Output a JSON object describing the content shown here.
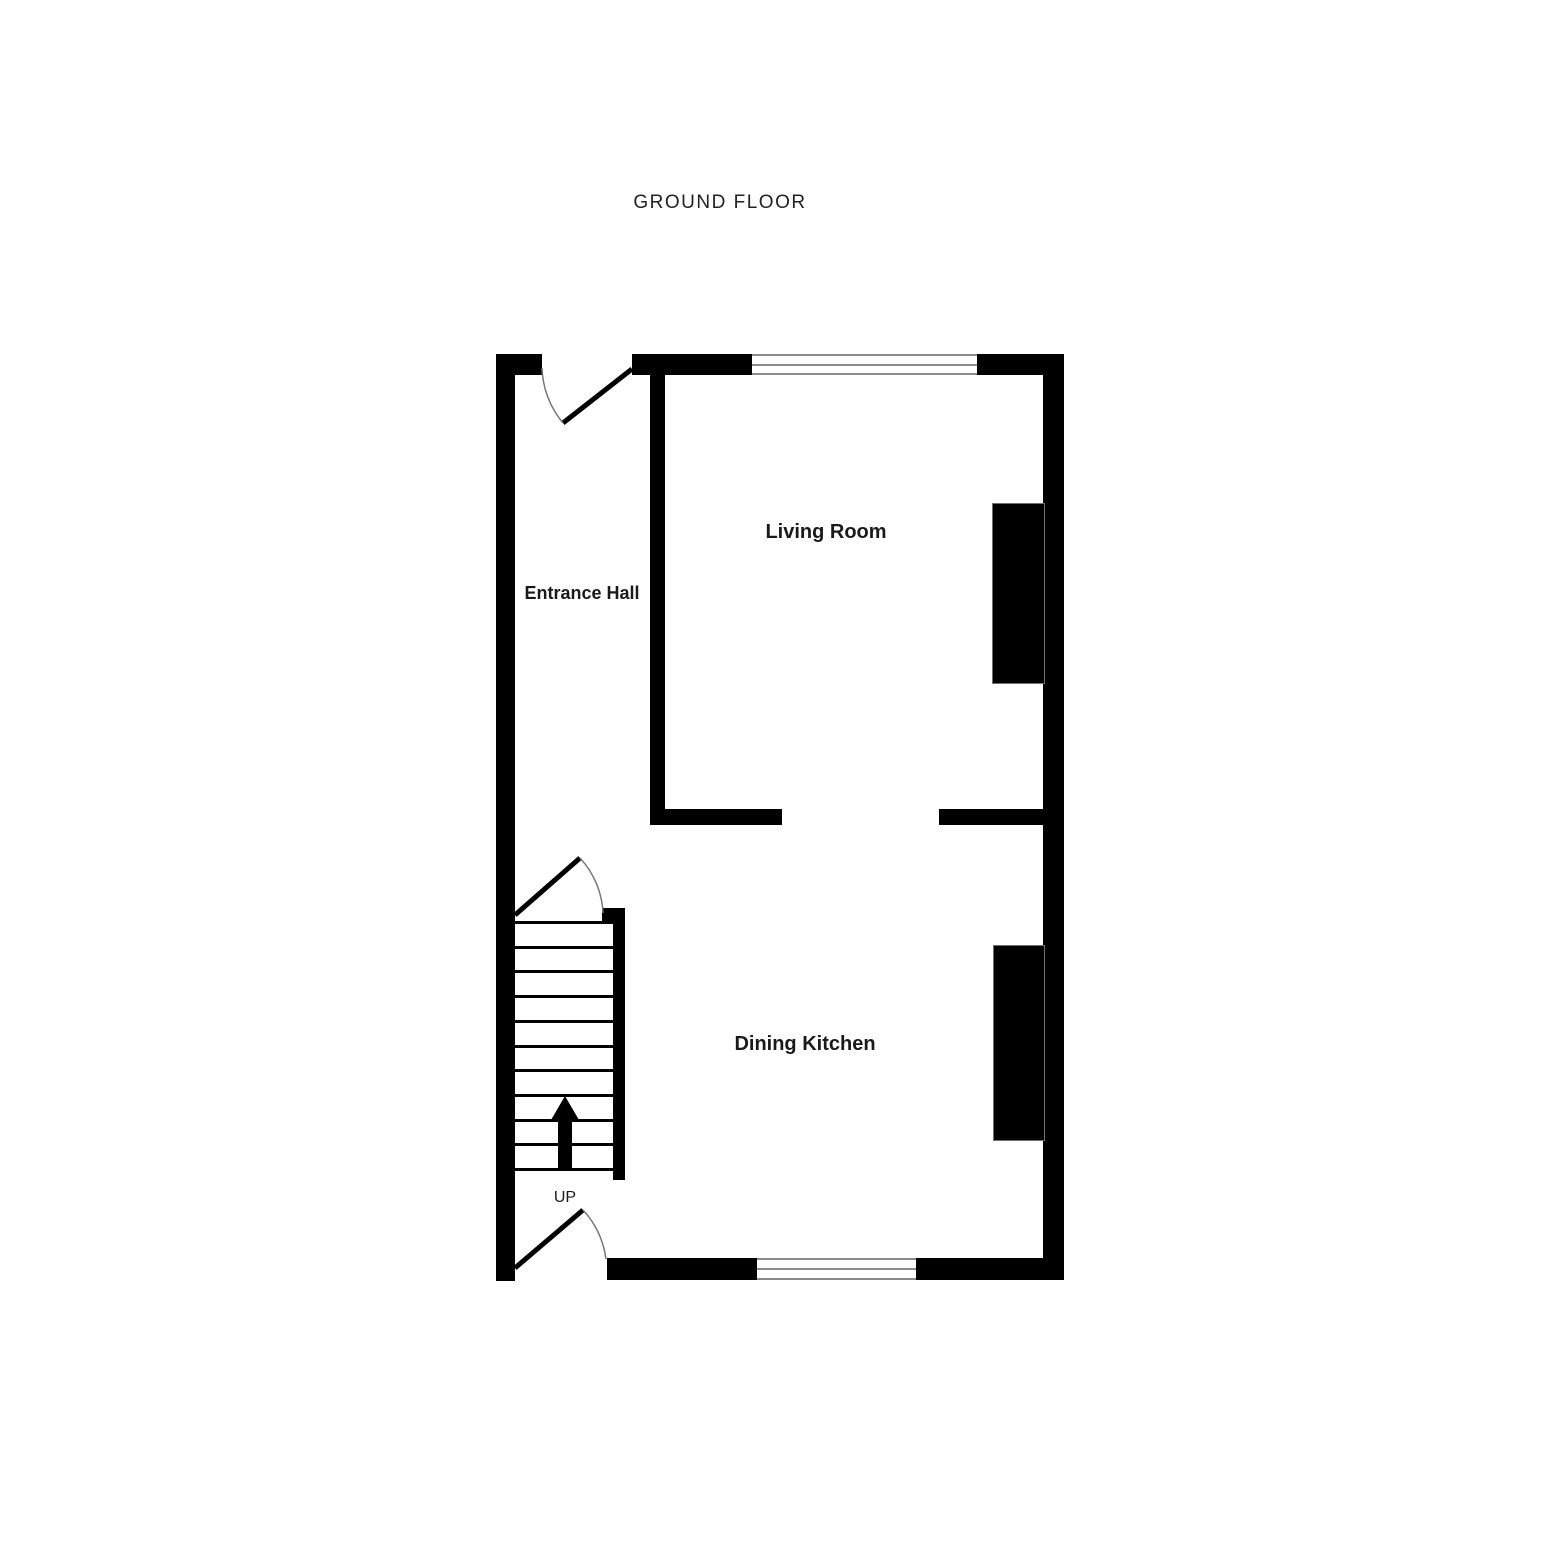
{
  "title": "GROUND FLOOR",
  "rooms": {
    "living_room": {
      "label": "Living Room"
    },
    "entrance_hall": {
      "label": "Entrance Hall"
    },
    "dining_kitchen": {
      "label": "Dining Kitchen"
    }
  },
  "stairs": {
    "label": "UP",
    "tread_count": 11,
    "direction": "up"
  },
  "windows": {
    "count": 2
  },
  "doors": {
    "count": 3
  },
  "colors": {
    "wall": "#000000",
    "background": "#ffffff",
    "window_frame": "#8a8a8a",
    "door_arc": "#777777",
    "text": "#1a1a1a"
  }
}
